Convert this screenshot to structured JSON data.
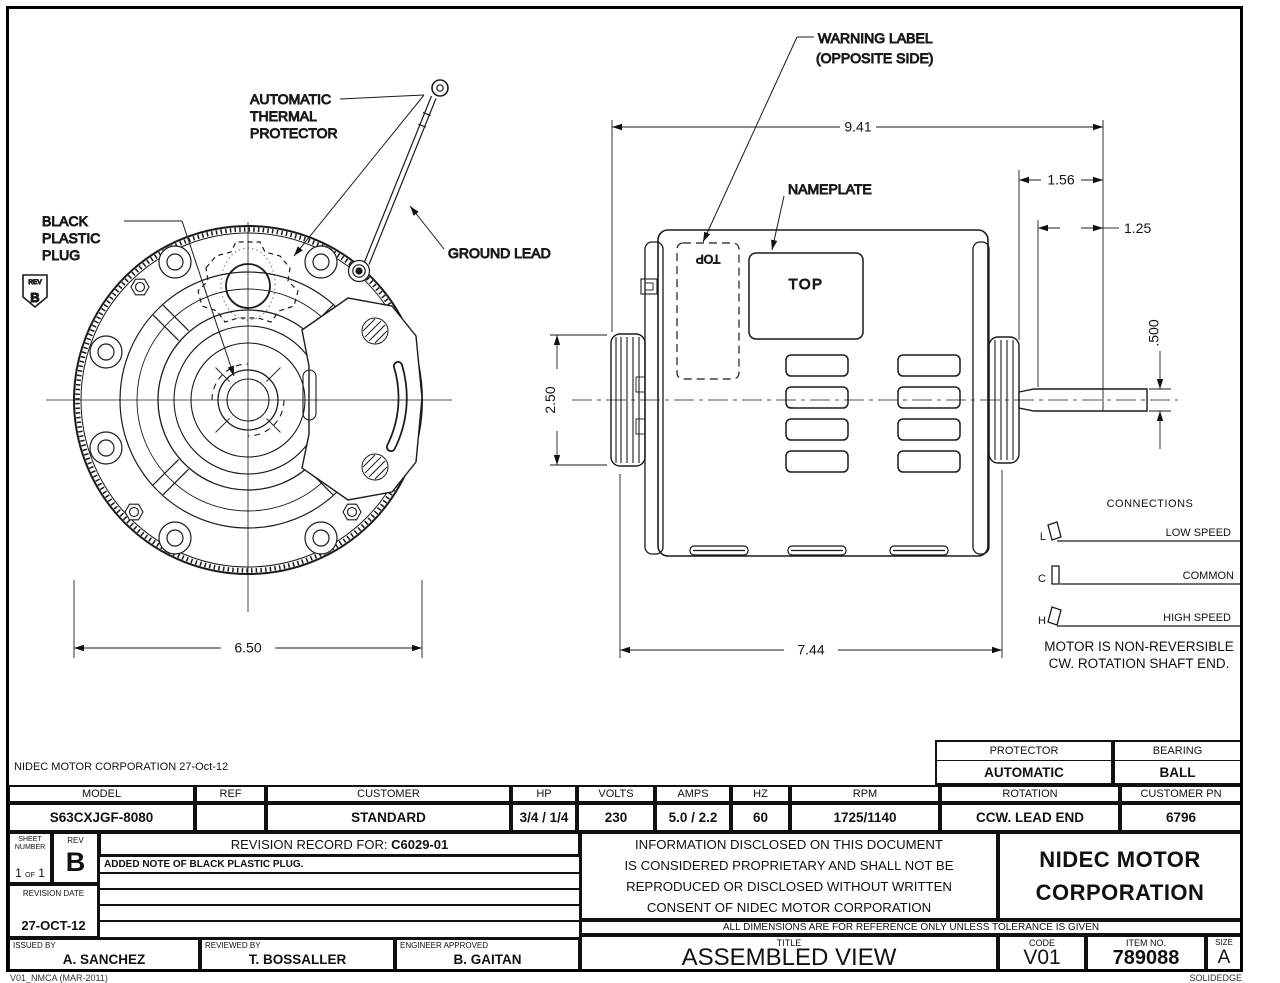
{
  "drawing": {
    "labels": {
      "thermal_1": "AUTOMATIC",
      "thermal_2": "THERMAL",
      "thermal_3": "PROTECTOR",
      "plug_1": "BLACK",
      "plug_2": "PLASTIC",
      "plug_3": "PLUG",
      "ground_lead": "GROUND LEAD",
      "warning_1": "WARNING LABEL",
      "warning_2": "(OPPOSITE SIDE)",
      "nameplate_callout": "NAMEPLATE",
      "nameplate_text": "TOP",
      "warning_label_text": "TOP"
    },
    "rev_flag": {
      "label": "REV",
      "value": "B"
    },
    "dims": {
      "overall_length": "9.41",
      "shaft_extension": "1.56",
      "shaft_flat": "1.25",
      "shaft_diameter": ".500",
      "hub_height": "2.50",
      "front_width": "6.50",
      "body_length": "7.44"
    },
    "connections": {
      "title": "CONNECTIONS",
      "rows": [
        {
          "terminal": "L",
          "label": "LOW SPEED"
        },
        {
          "terminal": "C",
          "label": "COMMON"
        },
        {
          "terminal": "H",
          "label": "HIGH SPEED"
        }
      ],
      "note1": "MOTOR IS NON-REVERSIBLE",
      "note2": "CW. ROTATION SHAFT END."
    }
  },
  "title_block": {
    "header_note": "NIDEC MOTOR CORPORATION 27-Oct-12",
    "protector": {
      "label": "PROTECTOR",
      "value": "AUTOMATIC"
    },
    "bearing": {
      "label": "BEARING",
      "value": "BALL"
    },
    "spec": {
      "headers": [
        "MODEL",
        "REF",
        "CUSTOMER",
        "HP",
        "VOLTS",
        "AMPS",
        "HZ",
        "RPM",
        "ROTATION",
        "CUSTOMER PN"
      ],
      "values": [
        "S63CXJGF-8080",
        "",
        "STANDARD",
        "3/4 / 1/4",
        "230",
        "5.0 / 2.2",
        "60",
        "1725/1140",
        "CCW. LEAD END",
        "6796"
      ]
    },
    "revision": {
      "sheet_label1": "SHEET",
      "sheet_label2": "NUMBER",
      "sheet_v1": "1",
      "sheet_of": "OF",
      "sheet_v2": "1",
      "rev_label": "REV",
      "rev_value": "B",
      "record_label": "REVISION RECORD FOR:",
      "record_number": "C6029-01",
      "note": "ADDED NOTE OF BLACK PLASTIC PLUG.",
      "date_label": "REVISION DATE",
      "date_value": "27-OCT-12"
    },
    "signatures": [
      {
        "label": "ISSUED BY",
        "name": "A. SANCHEZ"
      },
      {
        "label": "REVIEWED BY",
        "name": "T. BOSSALLER"
      },
      {
        "label": "ENGINEER APPROVED",
        "name": "B. GAITAN"
      }
    ],
    "proprietary": [
      "INFORMATION DISCLOSED ON THIS DOCUMENT",
      "IS CONSIDERED PROPRIETARY AND SHALL NOT BE",
      "REPRODUCED OR DISCLOSED WITHOUT WRITTEN",
      "CONSENT OF NIDEC MOTOR CORPORATION"
    ],
    "company1": "NIDEC MOTOR",
    "company2": "CORPORATION",
    "tolerance_note": "ALL DIMENSIONS ARE FOR REFERENCE ONLY UNLESS TOLERANCE IS GIVEN",
    "title": {
      "label": "TITLE",
      "value": "ASSEMBLED VIEW"
    },
    "code": {
      "label": "CODE",
      "value": "V01"
    },
    "item": {
      "label": "ITEM NO.",
      "value": "789088"
    },
    "size": {
      "label": "SIZE",
      "value": "A"
    }
  },
  "footer": {
    "left": "V01_NMCA (MAR-2011)",
    "right": "SOLIDEDGE"
  }
}
